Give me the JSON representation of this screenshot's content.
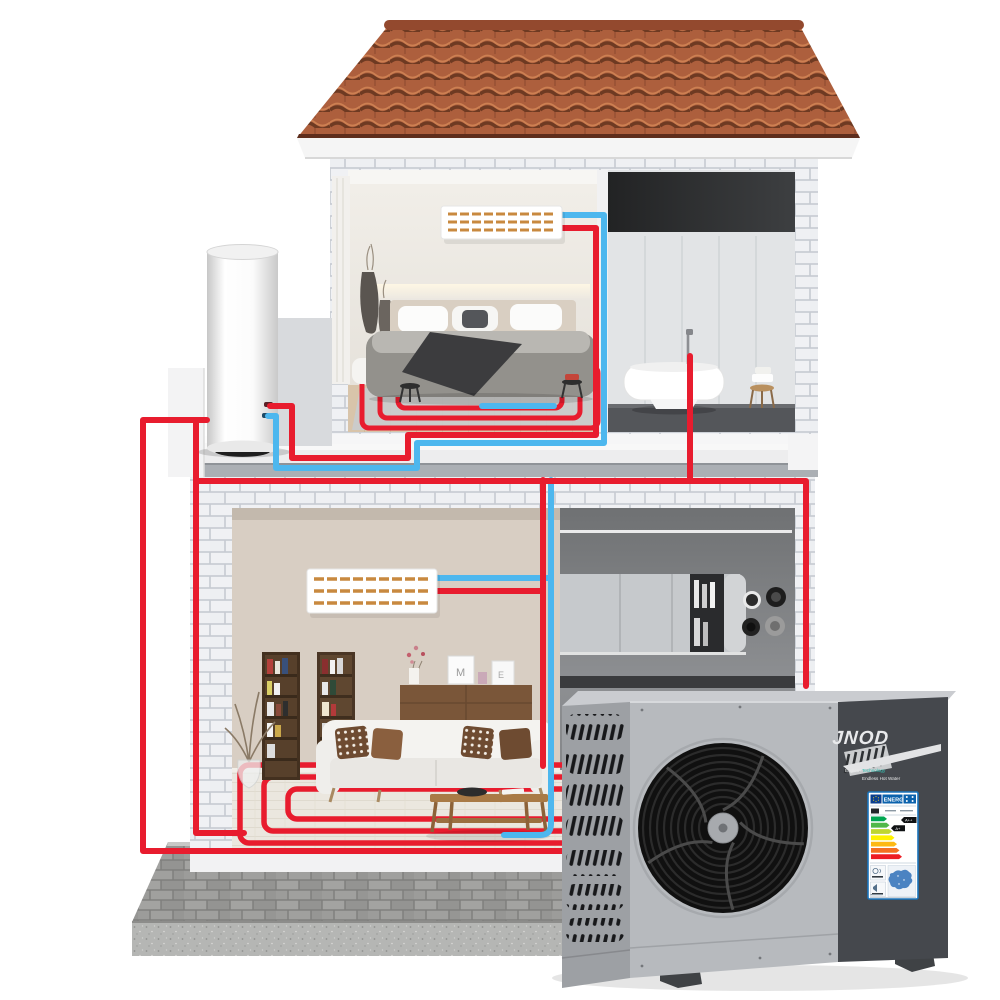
{
  "scene": {
    "pipes": {
      "hot_color": "#e81c2e",
      "cold_color": "#4db7ee"
    },
    "living_room": {
      "frame_letter_1": "M",
      "frame_letter_2": "E"
    },
    "heat_pump": {
      "brand": "JNOD",
      "tagline_word_1": "Endless",
      "tagline_word_2": "Technology",
      "tagline_line_2": "Endless Hot Water",
      "energy_label": {
        "header": "ENERG",
        "rating_tag_1": "A++",
        "rating_tag_2": "A+",
        "bar_colors": [
          "#00a651",
          "#50b848",
          "#bed630",
          "#fff200",
          "#fdb913",
          "#f37021",
          "#ed1c24"
        ]
      }
    }
  }
}
